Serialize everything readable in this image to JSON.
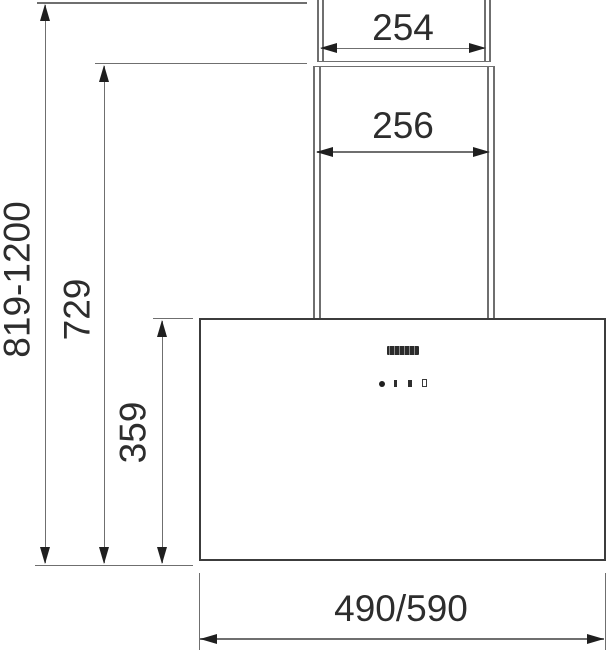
{
  "diagram": {
    "type": "cooker-hood-installation-dimension-drawing",
    "units": "mm"
  },
  "labels": {
    "chimney_top_width": "254",
    "chimney_width": "256",
    "overall_height_range": "819-1200",
    "min_total_height": "729",
    "body_height": "359",
    "body_width": "490/590"
  },
  "hood": {
    "parts": [
      "telescopic-chimney-upper",
      "telescopic-chimney-lower",
      "hood-body"
    ],
    "controls": [
      "power-dot-button",
      "speed-1-button",
      "speed-2-button",
      "speed-3-button"
    ],
    "logo": "brand-logo-badge"
  },
  "colors": {
    "background": "#ffffff",
    "thin_line": "#6f6f6f",
    "body_outline": "#3c3c3c",
    "arrow": "#1f1f1f",
    "text": "#2d2d2d",
    "logo_badge": "#2b2b2b"
  }
}
